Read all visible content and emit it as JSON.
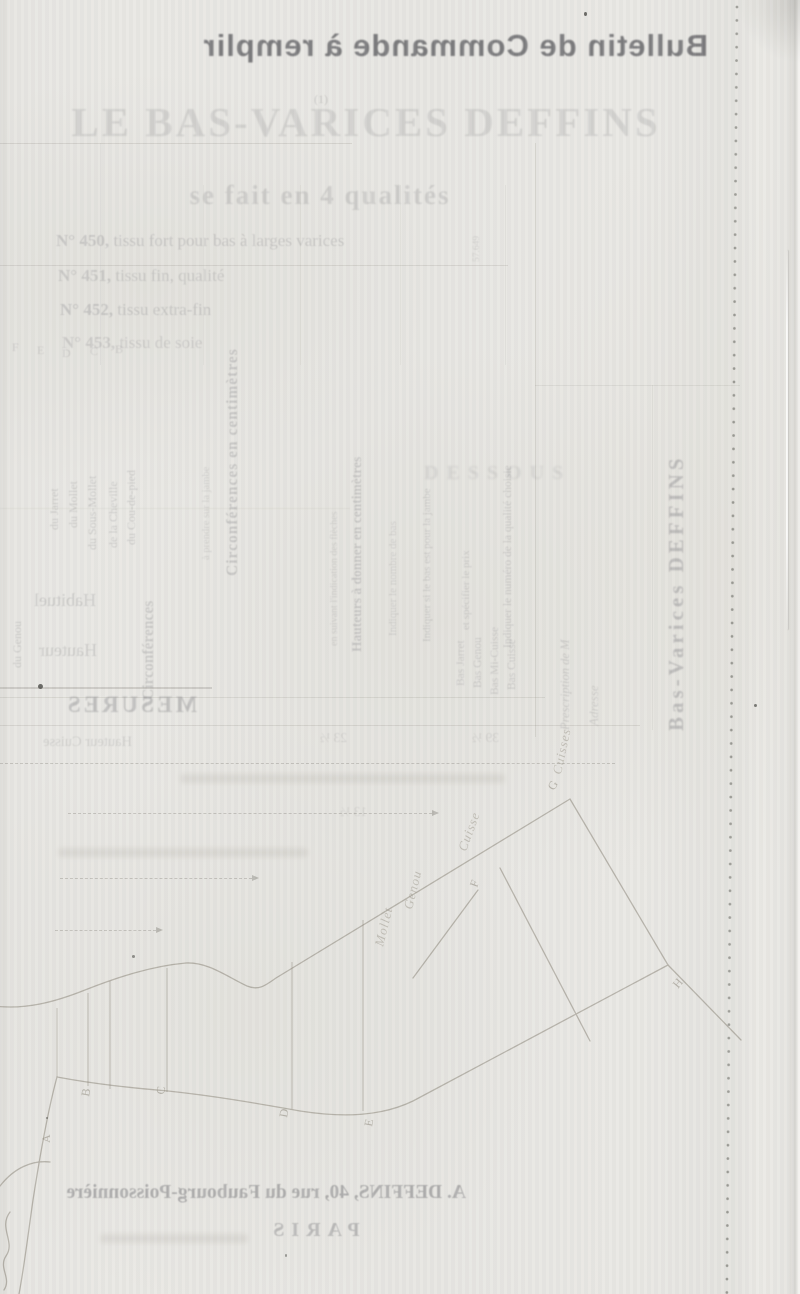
{
  "header": {
    "title": "Bulletin de Commande à remplir"
  },
  "ghost": {
    "product_title": "LE BAS-VARICES DEFFINS",
    "footnote_mark": "(1)",
    "qualities_heading": "se fait en 4 qualités",
    "qualities": [
      {
        "no": "N° 450,",
        "desc": "tissu fort pour bas à larges varices"
      },
      {
        "no": "N° 451,",
        "desc": "tissu fin, qualité"
      },
      {
        "no": "N° 452,",
        "desc": "tissu extra-fin"
      },
      {
        "no": "N° 453,",
        "desc": "tissu de soie"
      }
    ],
    "ref_number": "57.649",
    "instructions": {
      "qualite": "Indiquer le numéro de la qualité choisie",
      "prix": "et spécifier le prix",
      "jambe": "Indiquer si le bas est pour la jambe",
      "nombre": "Indiquer le nombre de bas",
      "hauteurs": "Hauteurs à donner en centimètres",
      "fleches": "en suivant l'indication des flèches",
      "dessous": "DESSOUS",
      "circonferences": "Circonférences en centimètres",
      "circonferences_short": "Circonférences",
      "prendre": "à prendre sur la jambe"
    },
    "bas_types": [
      "Bas Cuisse",
      "Bas Mi-Cuisse",
      "Bas Genou",
      "Bas Jarret"
    ],
    "leg_parts": [
      "du Cou-de-pied",
      "de la Cheville",
      "du Sous-Mollet",
      "du Mollet",
      "du Jarret",
      "du Genou"
    ],
    "letters_row": [
      "F",
      "E",
      "D",
      "C",
      "B"
    ],
    "fields": {
      "habituel": "Habituel",
      "hauteur": "Hauteur",
      "prescription": "Prescription de M",
      "adresse": "Adresse"
    },
    "mesures_title": "MESURES",
    "mesures_row_label": "Hauteur Cuisse",
    "values": [
      "23 ½",
      "39 ½",
      "13 ½"
    ],
    "brand_vertical": "Bas-Varices DEFFINS"
  },
  "diagram": {
    "letters": [
      "A",
      "B",
      "C",
      "D",
      "E",
      "F",
      "G",
      "H"
    ],
    "labels": [
      "Mollet",
      "Genou",
      "Cuisse",
      "Cuisses"
    ]
  },
  "footer": {
    "address": "A. DEFFINS, 40, rue du Faubourg-Poissonnière",
    "city": "PARIS"
  },
  "colors": {
    "paper": "#e9e8e4",
    "ink": "#4f4f52",
    "ghost": "#8a8a8e",
    "pencil": "#857f72"
  }
}
